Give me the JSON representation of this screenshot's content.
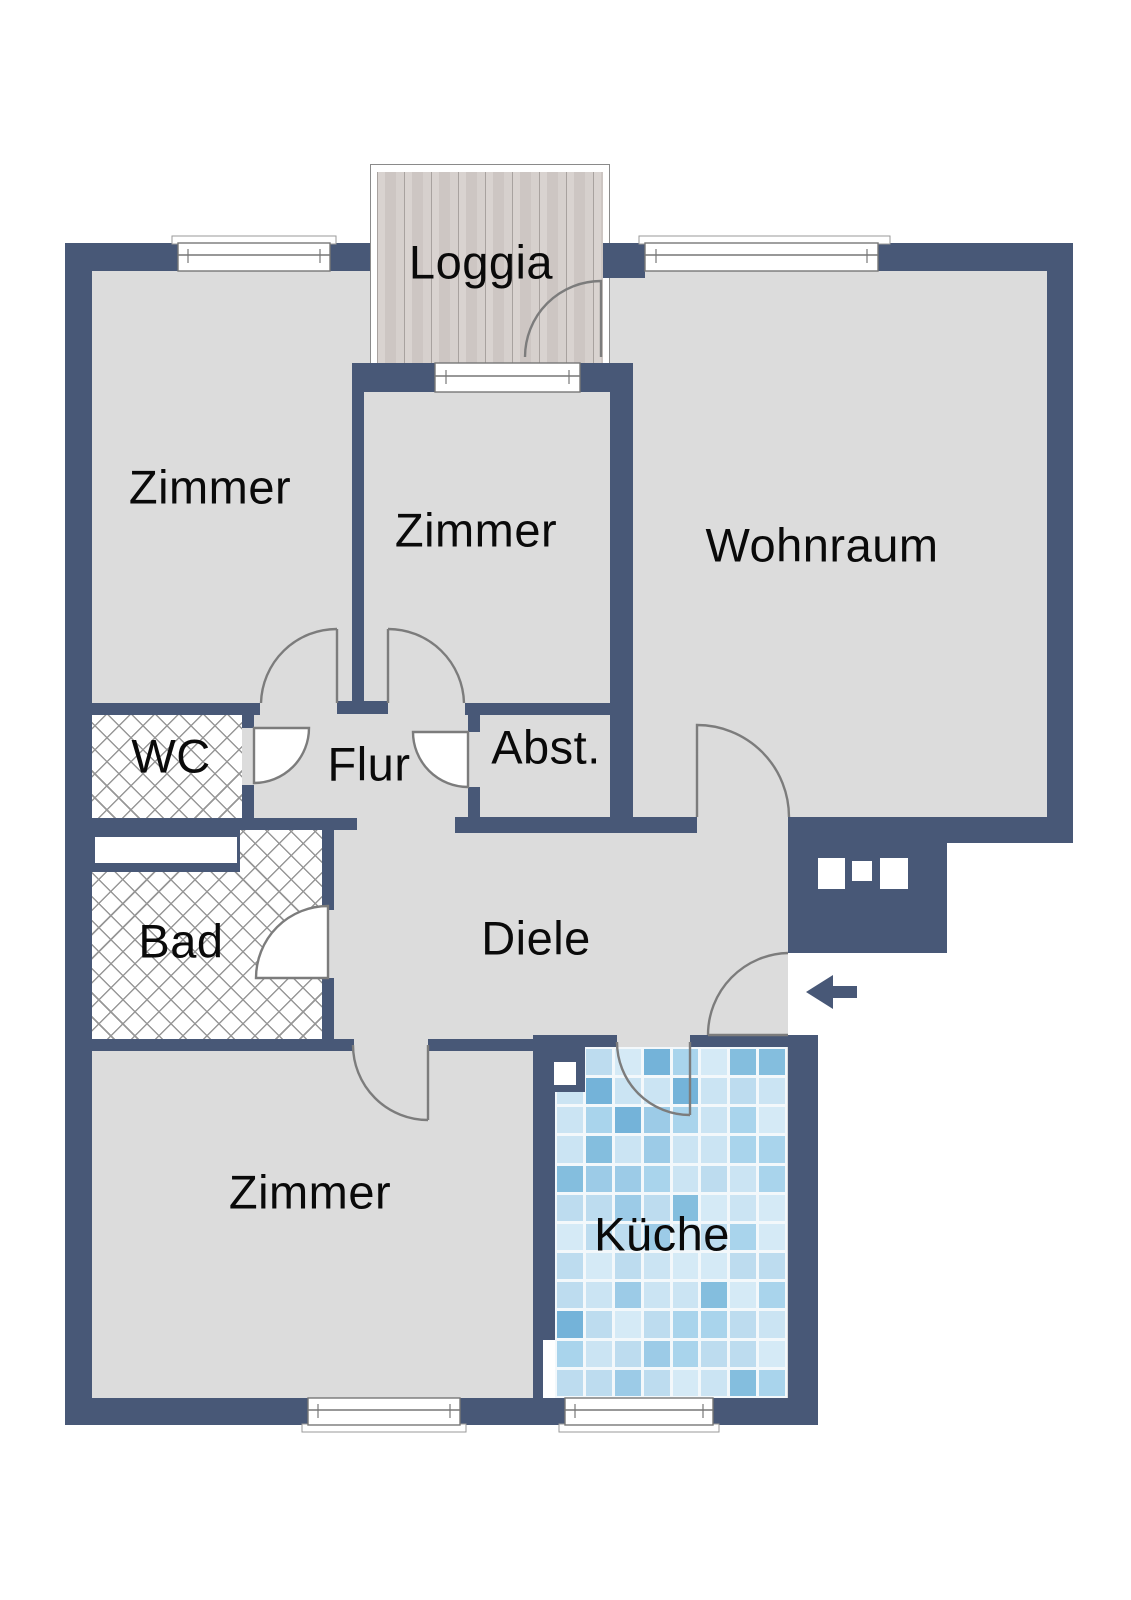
{
  "plan": {
    "rooms": [
      {
        "id": "loggia",
        "label": "Loggia",
        "texture": "wood-deck"
      },
      {
        "id": "zimmer-top-left",
        "label": "Zimmer",
        "texture": "plain"
      },
      {
        "id": "zimmer-top-middle",
        "label": "Zimmer",
        "texture": "plain"
      },
      {
        "id": "wohnraum",
        "label": "Wohnraum",
        "texture": "plain"
      },
      {
        "id": "wc",
        "label": "WC",
        "texture": "cross-hatch"
      },
      {
        "id": "flur",
        "label": "Flur",
        "texture": "plain"
      },
      {
        "id": "abstellraum",
        "label": "Abst.",
        "texture": "plain"
      },
      {
        "id": "bad",
        "label": "Bad",
        "texture": "cross-hatch"
      },
      {
        "id": "diele",
        "label": "Diele",
        "texture": "plain"
      },
      {
        "id": "zimmer-bottom",
        "label": "Zimmer",
        "texture": "plain"
      },
      {
        "id": "kueche",
        "label": "Küche",
        "texture": "tile-mosaic"
      }
    ],
    "entrance": {
      "symbol": "arrow-left"
    },
    "colors": {
      "wall": "#485877",
      "floor": "#dcdcdc",
      "door_outline": "#7c7c7c",
      "wood_light": "#d9d3d0",
      "wood_dark": "#cdc6c3",
      "tile_grout": "#f3f8fb",
      "tile_palette": [
        "#cbe4f3",
        "#bddcef",
        "#d5eaf6",
        "#a9d4ec",
        "#9ccbe7",
        "#84bede",
        "#74b3d9"
      ],
      "tile_weights": [
        3,
        3,
        2,
        2,
        1,
        1,
        1
      ]
    }
  }
}
